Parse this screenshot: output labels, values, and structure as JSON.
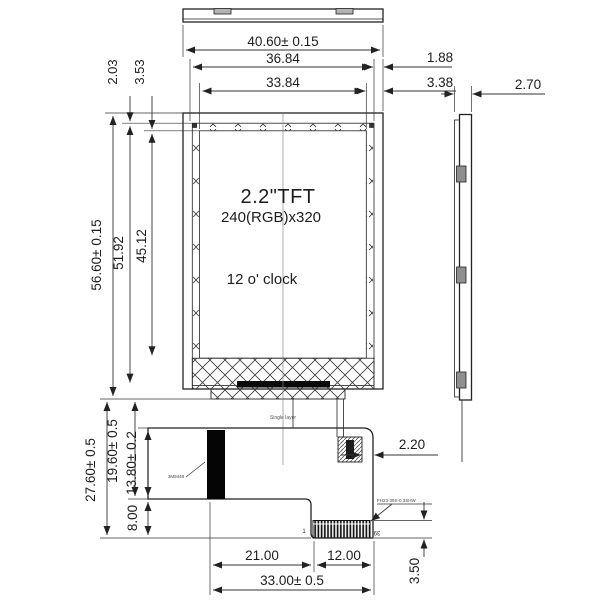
{
  "drawing": {
    "display": {
      "title": "2.2\"TFT",
      "resolution": "240(RGB)x320",
      "viewing_direction": "12 o'  clock"
    },
    "annotations": {
      "single_layer": "Single layer",
      "stiffener_label": "3M9448",
      "connector_part": "FH23-39S-0.3SHW",
      "pin_first": "1",
      "pin_last": "39"
    },
    "dims": {
      "total_width": "40.60± 0.15",
      "window_width": "36.84",
      "active_width": "33.84",
      "margin_window_right": "1.88",
      "margin_active_right": "3.38",
      "thickness": "2.70",
      "margin_window_top": "2.03",
      "margin_active_top": "3.53",
      "total_height": "56.60± 0.15",
      "window_height": "51.92",
      "active_height": "45.12",
      "fpc_total_height": "27.60± 0.5",
      "fpc_to_step_height": "19.60± 0.5",
      "fpc_upper_height": "13.80± 0.2",
      "fpc_lower_height": "8.00",
      "fpc_left_width": "21.00",
      "fpc_connector_width": "12.00",
      "fpc_total_width": "33.00± 0.5",
      "connector_height": "3.50",
      "connector_offset": "2.20"
    }
  }
}
